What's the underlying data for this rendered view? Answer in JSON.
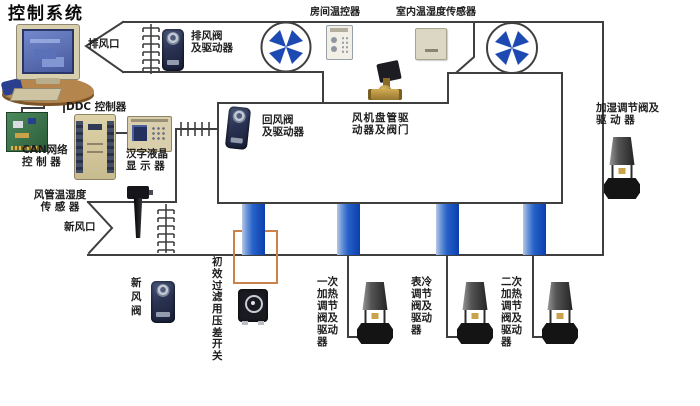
{
  "title": "控制系统",
  "colors": {
    "line": "#3f3f3f",
    "fan_blade": "#1d4ab2",
    "coil_blue": "#1250c2",
    "filter_box_orange": "#c8824a"
  },
  "labels": {
    "exhaust_vent": "排风口",
    "exhaust_damper": {
      "l1": "排风阀",
      "l2": "及驱动器"
    },
    "room_thermostat": "房间温控器",
    "indoor_sensor": "室内温湿度传感器",
    "ddc": "DDC 控制器",
    "can": {
      "l1": "CAN网络",
      "l2": "控 制 器"
    },
    "lcd": {
      "l1": "汉字液晶",
      "l2": "显 示 器"
    },
    "return_damper": {
      "l1": "回风阀",
      "l2": "及驱动器"
    },
    "fan_coil": {
      "l1": "风机盘管驱",
      "l2": "动器及阀门"
    },
    "humidifier_valve": {
      "l1": "加湿调节阀及",
      "l2": "驱  动  器"
    },
    "duct_sensor": {
      "l1": "风管温湿度",
      "l2": "传 感 器"
    },
    "fresh_air_vent": "新风口",
    "fresh_air_damper": "新风阀",
    "filter_switch": "初效过滤用压差开关",
    "valve1": "一次加热调节阀及驱动器",
    "valve2": "表冷调节阀及驱动器",
    "valve3": "二次加热调节阀及驱动器"
  }
}
